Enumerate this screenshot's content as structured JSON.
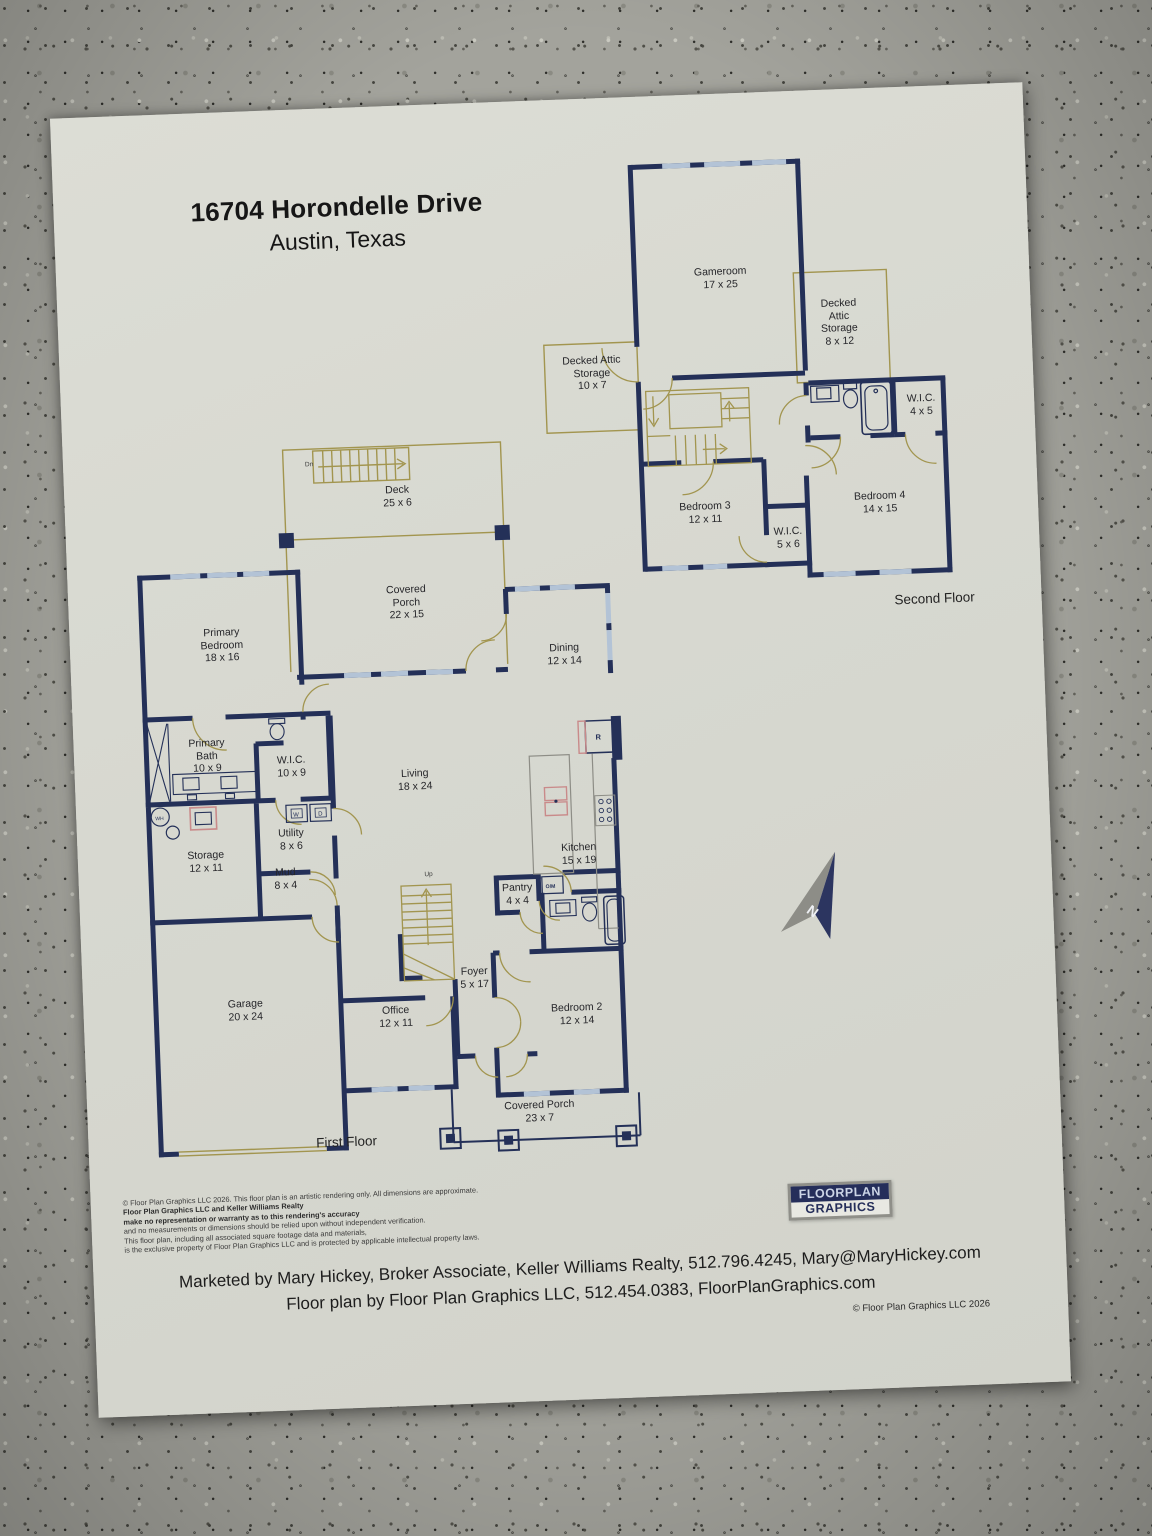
{
  "colors": {
    "wall_navy": "#243058",
    "tan": "#a2954f",
    "window_blue": "#b3c3d6",
    "paper": "#d7d8d0",
    "fixture_pink": "#c98a8a"
  },
  "header": {
    "address": "16704 Horondelle Drive",
    "city": "Austin, Texas"
  },
  "floors": {
    "first_label": "First Floor",
    "second_label": "Second Floor"
  },
  "rooms": {
    "gameroom": {
      "name": "Gameroom",
      "dims": "17 x 25"
    },
    "attic_right": {
      "name": "Decked Attic Storage",
      "dims": "8 x 12"
    },
    "attic_left": {
      "name": "Decked Attic Storage",
      "dims": "10 x 7"
    },
    "wic_45": {
      "name": "W.I.C.",
      "dims": "4 x 5"
    },
    "bedroom3": {
      "name": "Bedroom 3",
      "dims": "12 x 11"
    },
    "wic_56": {
      "name": "W.I.C.",
      "dims": "5 x 6"
    },
    "bedroom4": {
      "name": "Bedroom 4",
      "dims": "14 x 15"
    },
    "deck": {
      "name": "Deck",
      "dims": "25 x 6"
    },
    "covered_porch_rear": {
      "name": "Covered Porch",
      "dims": "22 x 15"
    },
    "primary_bedroom": {
      "name": "Primary Bedroom",
      "dims": "18 x 16"
    },
    "dining": {
      "name": "Dining",
      "dims": "12 x 14"
    },
    "primary_bath": {
      "name": "Primary Bath",
      "dims": "10 x 9"
    },
    "wic_109": {
      "name": "W.I.C.",
      "dims": "10 x 9"
    },
    "living": {
      "name": "Living",
      "dims": "18 x 24"
    },
    "kitchen": {
      "name": "Kitchen",
      "dims": "15 x 19"
    },
    "storage": {
      "name": "Storage",
      "dims": "12 x 11"
    },
    "utility": {
      "name": "Utility",
      "dims": "8 x 6"
    },
    "mud": {
      "name": "Mud",
      "dims": "8 x 4"
    },
    "garage": {
      "name": "Garage",
      "dims": "20 x 24"
    },
    "office": {
      "name": "Office",
      "dims": "12 x 11"
    },
    "foyer": {
      "name": "Foyer",
      "dims": "5 x 17"
    },
    "pantry": {
      "name": "Pantry",
      "dims": "4 x 4"
    },
    "bedroom2": {
      "name": "Bedroom 2",
      "dims": "12 x 14"
    },
    "covered_porch_front": {
      "name": "Covered Porch",
      "dims": "23 x 7"
    }
  },
  "markers": {
    "water_heater": "WH",
    "washer": "W",
    "dryer": "D",
    "refrigerator": "R",
    "oven_microwave": "O/M",
    "stairs_up": "Up",
    "stairs_down": "Dn",
    "north": "N"
  },
  "footer": {
    "disclaimer_lines": [
      "© Floor Plan Graphics LLC 2026. This floor plan is an artistic rendering only. All dimensions are approximate.",
      "Floor Plan Graphics LLC and Keller Williams Realty",
      "make no representation or warranty as to this rendering's accuracy",
      "and no measurements or dimensions should be relied upon without independent verification.",
      "This floor plan, including all associated square footage data and materials,",
      "is the exclusive property of Floor Plan Graphics LLC and is protected by applicable intellectual property laws."
    ],
    "logo_line1": "FloorPlan",
    "logo_line2": "Graphics",
    "marketing_line1": "Marketed by Mary Hickey, Broker Associate, Keller Williams Realty, 512.796.4245, Mary@MaryHickey.com",
    "marketing_line2": "Floor plan by Floor Plan Graphics LLC, 512.454.0383, FloorPlanGraphics.com",
    "copyright": "© Floor Plan Graphics LLC 2026"
  }
}
